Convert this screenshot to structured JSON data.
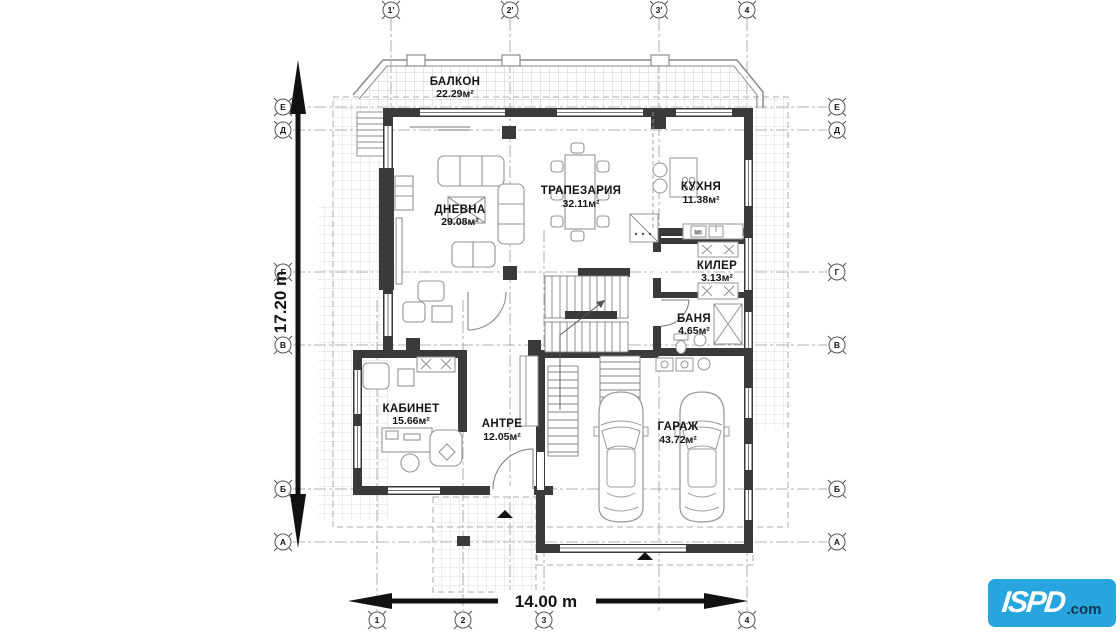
{
  "plan": {
    "rooms": [
      {
        "name": "БАЛКОН",
        "area": "22.29м²"
      },
      {
        "name": "ДНЕВНА",
        "area": "29.08м²"
      },
      {
        "name": "ТРАПЕЗАРИЯ",
        "area": "32.11м²"
      },
      {
        "name": "КУХНЯ",
        "area": "11.38м²"
      },
      {
        "name": "КИЛЕР",
        "area": "3.13м²"
      },
      {
        "name": "БАНЯ",
        "area": "4.65м²"
      },
      {
        "name": "КАБИНЕТ",
        "area": "15.66м²"
      },
      {
        "name": "АНТРЕ",
        "area": "12.05м²"
      },
      {
        "name": "ГАРАЖ",
        "area": "43.72м²"
      }
    ],
    "dimensions": {
      "horizontal": "14.00 m",
      "vertical": "17.20 m"
    },
    "grid_markers": {
      "top": [
        "1'",
        "2'",
        "3'",
        "4"
      ],
      "bottom": [
        "1",
        "2",
        "3",
        "4"
      ],
      "left": [
        "Е",
        "Д",
        "Г",
        "В",
        "Б",
        "А"
      ],
      "right": [
        "Е",
        "Д",
        "Г",
        "В",
        "Б",
        "А"
      ]
    },
    "labels": {
      "appliance": "мс"
    },
    "colors": {
      "wall": "#3a3a3a",
      "logo_blue": "#27a5df",
      "logo_navy": "#12364f"
    }
  },
  "logo": {
    "brand": "ISPD",
    "suffix": ".com"
  }
}
